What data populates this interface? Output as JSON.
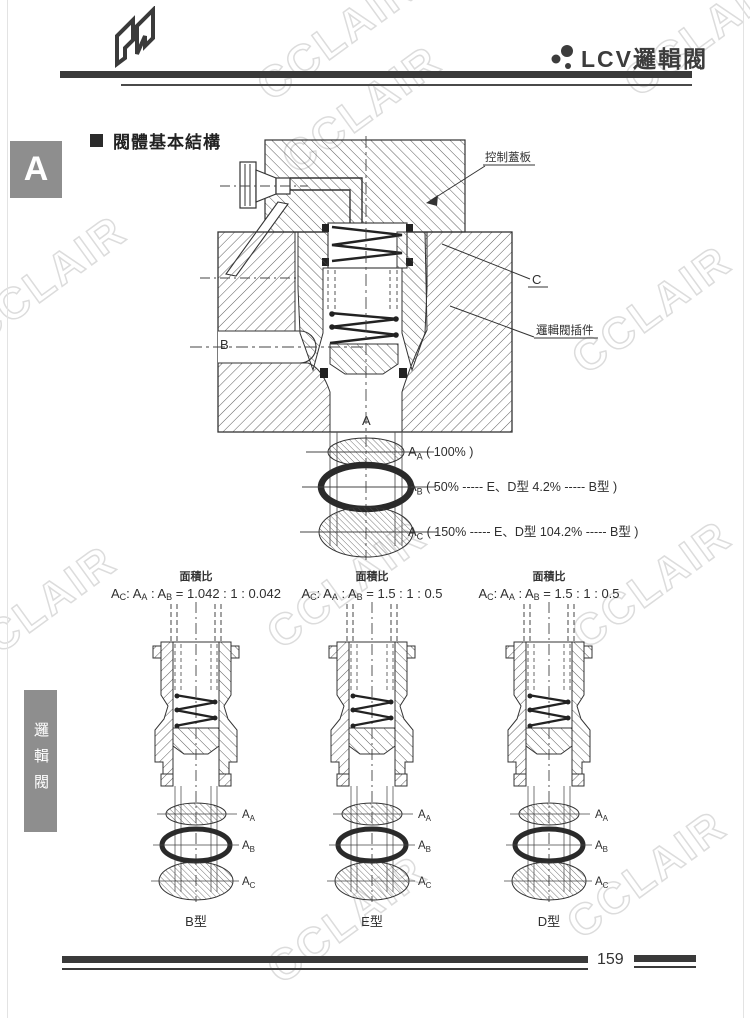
{
  "page": {
    "number": "159",
    "watermark_text": "CCLAIR"
  },
  "header": {
    "logo_letter": "N",
    "title": "LCV邏輯閥"
  },
  "side_tab": {
    "letter": "A"
  },
  "sidebar": {
    "vertical_label": "邏輯閥"
  },
  "section": {
    "heading": "閥體基本結構"
  },
  "main_figure": {
    "callout_cover": "控制蓋板",
    "callout_cartridge": "邏輯閥插件",
    "label_c": "C",
    "label_b": "B",
    "label_a": "A",
    "area_labels": [
      {
        "sym": "A",
        "sub": "A",
        "desc": " ( 100% )"
      },
      {
        "sym": "A",
        "sub": "B",
        "desc": " ( 50% ----- E、D型  4.2% ----- B型 )"
      },
      {
        "sym": "A",
        "sub": "C",
        "desc": " ( 150% ----- E、D型  104.2% ----- B型 )"
      }
    ]
  },
  "ratio": {
    "heading": "面積比",
    "prefix": {
      "a1": "A",
      "s1": "C",
      "sep1": ": ",
      "a2": "A",
      "s2": "A",
      "sep2": " : ",
      "a3": "A",
      "s3": "B",
      "sep3": " = "
    }
  },
  "diagrams": [
    {
      "value": "1.042 : 1 : 0.042",
      "type_label": "B型"
    },
    {
      "value": "1.5 : 1 : 0.5",
      "type_label": "E型"
    },
    {
      "value": "1.5 : 1 : 0.5",
      "type_label": "D型"
    }
  ],
  "cartridge_labels": [
    {
      "sym": "A",
      "sub": "A"
    },
    {
      "sym": "A",
      "sub": "B"
    },
    {
      "sym": "A",
      "sub": "C"
    }
  ]
}
